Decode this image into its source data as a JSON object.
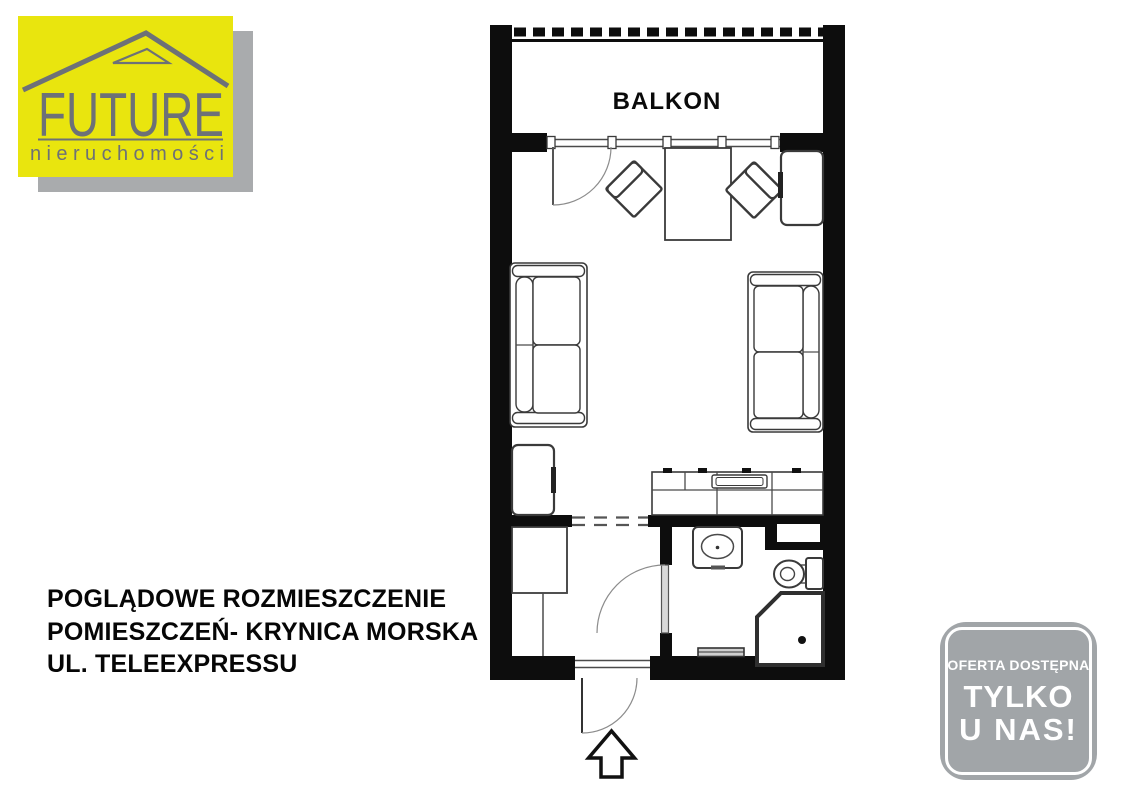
{
  "flyer": {
    "logo": {
      "brand": "FUTURE",
      "tagline": "nieruchomości"
    },
    "plan": {
      "balcony_label": "BALKON"
    },
    "caption": {
      "lines": [
        "POGLĄDOWE ROZMIESZCZENIE",
        "POMIESZCZEŃ- KRYNICA MORSKA",
        "UL. TELEEXPRESSU"
      ]
    },
    "badge": {
      "lines": [
        "OFERTA DOSTĘPNA",
        "TYLKO",
        "U NAS!"
      ]
    },
    "colors": {
      "logo_yellow": "#e9e50e",
      "logo_text_gray": "#6d7177",
      "logo_shadow_gray": "#a9abad",
      "badge_gray": "#a1a5a8",
      "wall_black": "#0d0d0d"
    }
  }
}
